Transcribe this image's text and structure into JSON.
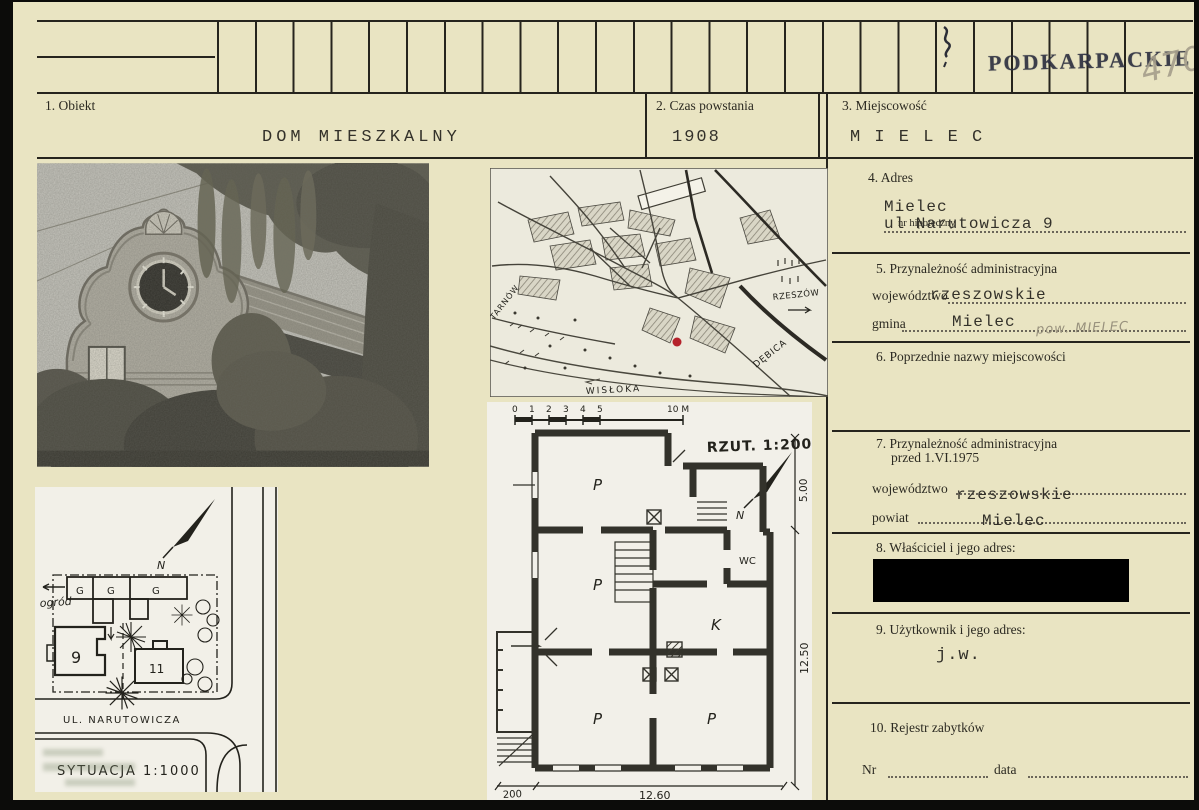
{
  "card": {
    "stamp": "PODKARPACKIE",
    "inventory_no": "4708",
    "colors": {
      "paper": "#e9e4c2",
      "ink": "#26241d",
      "stamp_ink": "#2e3140",
      "pencil": "#98917d",
      "marker_red": "#b5222b",
      "redaction": "#000000"
    }
  },
  "fields": {
    "obiekt": {
      "label": "1. Obiekt",
      "value": "DOM MIESZKALNY"
    },
    "czas": {
      "label": "2. Czas powstania",
      "value": "1908"
    },
    "miejscowosc": {
      "label": "3. Miejscowość",
      "value": "M I E L E C"
    },
    "adres": {
      "label": "4. Adres",
      "hipoteczny_label": "nr hipoteczny",
      "line1": "Mielec",
      "line2": "ul Narutowicza 9"
    },
    "admin": {
      "label": "5. Przynależność administracyjna",
      "wojewodztwo_label": "województwo",
      "wojewodztwo": "rzeszowskie",
      "gmina_label": "gmina",
      "gmina": "Mielec",
      "pencil_note": "pow. MIELEC"
    },
    "poprzednie": {
      "label": "6. Poprzednie nazwy miejscowości"
    },
    "admin_1975": {
      "label_line1": "7. Przynależność administracyjna",
      "label_line2": "przed 1.VI.1975",
      "wojewodztwo_label": "województwo",
      "wojewodztwo": "rzeszowskie",
      "powiat_label": "powiat",
      "powiat": "Mielec"
    },
    "wlasciciel": {
      "label": "8. Właściciel i jego adres:"
    },
    "uzytkownik": {
      "label": "9. Użytkownik i jego adres:",
      "value": "j.w."
    },
    "rejestr": {
      "label": "10. Rejestr zabytków",
      "nr_label": "Nr",
      "data_label": "data"
    }
  },
  "map": {
    "label_tarnow": "TARNÓW",
    "label_rzeszow": "RZESZÓW",
    "label_debica": "DĘBICA",
    "label_river": "WISŁOKA"
  },
  "floor_plan": {
    "title": "RZUT.  1:200",
    "north": "N",
    "scale_ticks": [
      "0",
      "1",
      "2",
      "3",
      "4",
      "5"
    ],
    "scale_end": "10 M",
    "dim_top_right": "5.00",
    "dim_right": "12.50",
    "dim_bottom_left": "200",
    "dim_bottom": "12.60",
    "rooms": [
      "P",
      "P",
      "P",
      "P",
      "K",
      "WC"
    ]
  },
  "site_plan": {
    "title": "SYTUACJA  1:1000",
    "street": "UL. NARUTOWICZA",
    "garden": "ogród",
    "north": "N",
    "garage": "G",
    "house_9": "9",
    "house_11": "11"
  }
}
